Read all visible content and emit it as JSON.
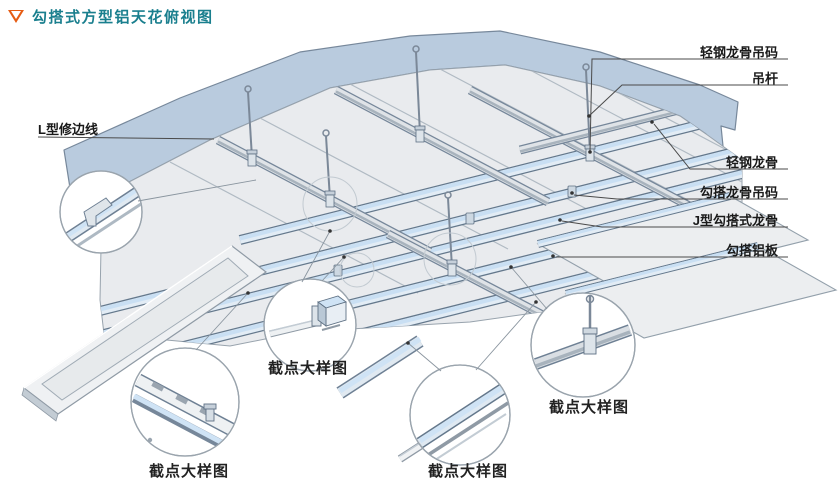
{
  "title": {
    "marker": "open-triangle-down",
    "text": "勾搭式方型铝天花俯视图"
  },
  "callouts": {
    "left": {
      "text": "L型修边线"
    },
    "right": [
      {
        "text": "轻钢龙骨吊码"
      },
      {
        "text": "吊杆"
      },
      {
        "text": "轻钢龙骨"
      },
      {
        "text": "勾搭龙骨吊码"
      },
      {
        "text": "J型勾搭式龙骨"
      },
      {
        "text": "勾搭铝板"
      }
    ],
    "details": [
      {
        "text": "截点大样图"
      },
      {
        "text": "截点大样图"
      },
      {
        "text": "截点大样图"
      },
      {
        "text": "截点大样图"
      }
    ]
  },
  "colors": {
    "title_text": "#1a7f8e",
    "title_triangle": "#e65c13",
    "wall_band": "#b9cbde",
    "panel": "#e9ebee",
    "keel_top_blue": "#cfe3f5",
    "runner_gray": "#a8b3bd",
    "label_text": "#1a1a1a",
    "leader_line": "#4a4a4a"
  }
}
